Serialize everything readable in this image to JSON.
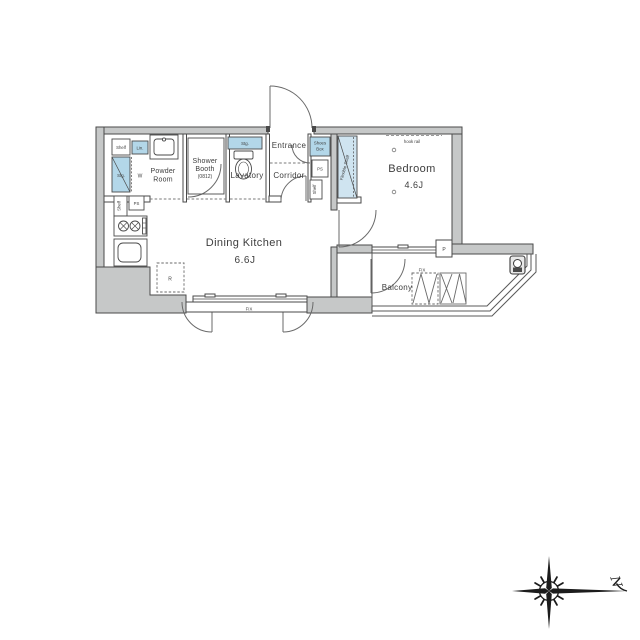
{
  "floorplan": {
    "rooms": {
      "dining_kitchen": {
        "name": "Dining Kitchen",
        "size": "6.6J"
      },
      "bedroom": {
        "name": "Bedroom",
        "size": "4.6J"
      },
      "entrance": {
        "name": "Entrance"
      },
      "corridor": {
        "name": "Corridor"
      },
      "lavatory": {
        "name": "Lavatory"
      },
      "powder_room": {
        "line1": "Powder",
        "line2": "Room"
      },
      "shower_booth": {
        "line1": "Shower",
        "line2": "Booth",
        "line3": "(0812)"
      },
      "balcony": {
        "name": "Balcony"
      }
    },
    "labels": {
      "shelf": "Shelf",
      "linen": "Lin.",
      "storage": "Stg.",
      "washer": "W",
      "ps": "PS",
      "shoes_box_line1": "Shoes",
      "shoes_box_line2": "Box",
      "flexible_shelf": "Flexible Shelf",
      "hook_rail": "hook rail",
      "refrigerator": "R",
      "fix": "FIX",
      "pipe_space": "P",
      "north": "N"
    },
    "colors": {
      "wall_fill": "#c6c8c8",
      "line": "#4a4a4a",
      "fixture_blue": "#b3d7e9",
      "closet_blue": "#cfe4f0"
    }
  }
}
